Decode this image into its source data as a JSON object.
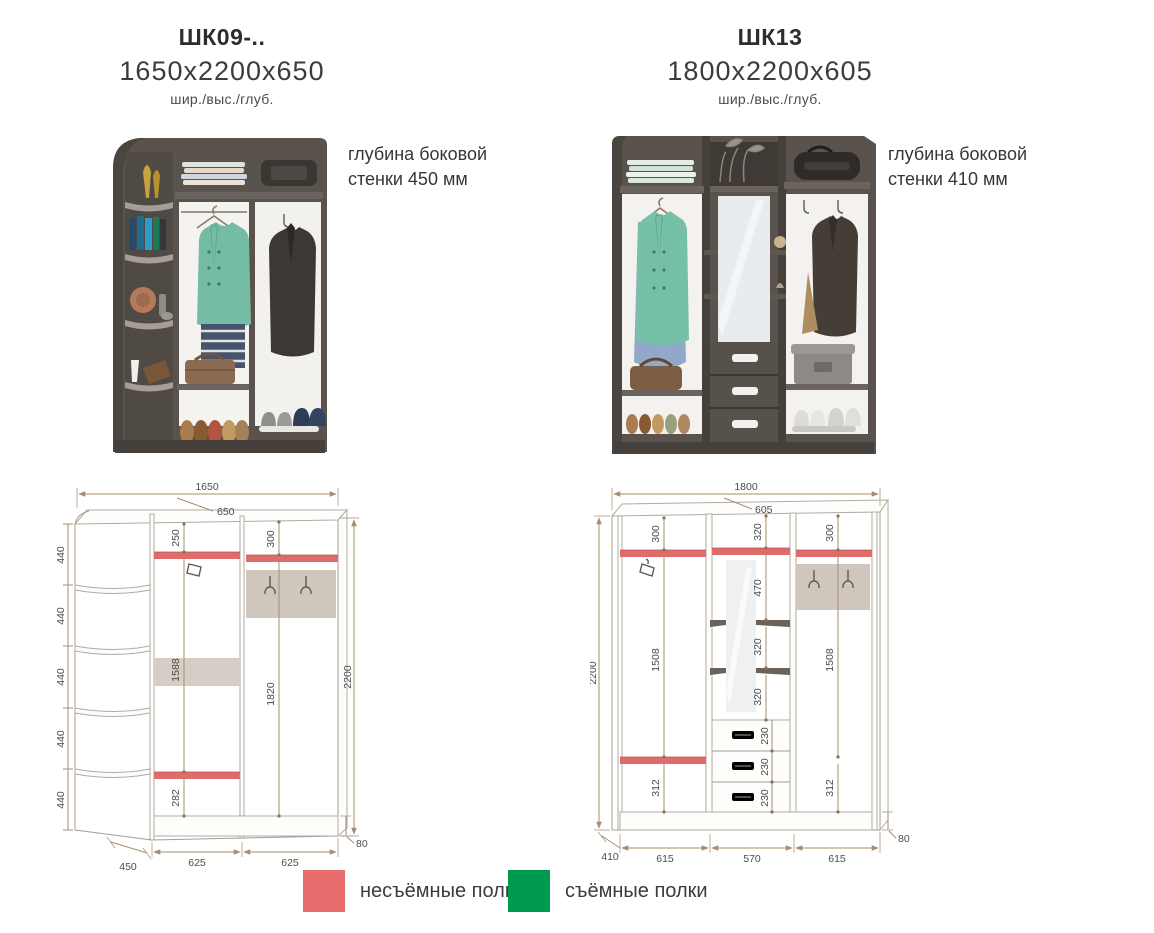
{
  "products": [
    {
      "title": "ШК09-..",
      "dimensions": "1650х2200х650",
      "dimensions_caption": "шир./выс./глуб.",
      "note_line1": "глубина боковой",
      "note_line2": "стенки 450 мм",
      "drawing": {
        "overall_width": "1650",
        "top_depth": "650",
        "overall_height": "2200",
        "plinth_height": "80",
        "side_sections": [
          "440",
          "440",
          "440",
          "440",
          "440"
        ],
        "mid_top_offset": "250",
        "mid_hanging": "1588",
        "mid_bottom": "282",
        "right_top_offset": "300",
        "right_hanging": "1820",
        "corner_depth": "450",
        "bay1_width": "625",
        "bay2_width": "625"
      }
    },
    {
      "title": "ШК13",
      "dimensions": "1800х2200х605",
      "dimensions_caption": "шир./выс./глуб.",
      "note_line1": "глубина боковой",
      "note_line2": "стенки 410 мм",
      "drawing": {
        "overall_width": "1800",
        "top_depth": "605",
        "overall_height": "2200",
        "plinth_height": "80",
        "left_top_offset": "300",
        "left_hanging": "1508",
        "left_bottom": "312",
        "mid_top_offset": "320",
        "mid_gap1": "470",
        "mid_gap2": "320",
        "mid_gap3": "320",
        "drawers": [
          "230",
          "230",
          "230"
        ],
        "right_top_offset": "300",
        "right_hanging": "1508",
        "right_bottom": "312",
        "side_depth": "410",
        "bay1_width": "615",
        "bay2_width": "570",
        "bay3_width": "615"
      }
    }
  ],
  "legend": {
    "items": [
      {
        "label": "несъёмные полки",
        "color": "#e66e6e"
      },
      {
        "label": "съёмные полки",
        "color": "#009a4e"
      }
    ]
  },
  "colors": {
    "fixed_shelf": "#df6b6b",
    "removable_shelf": "#009a4e",
    "dim_line": "#a58d6f",
    "dim_text": "#4c4c4c",
    "wardrobe_body": "#59524d"
  }
}
